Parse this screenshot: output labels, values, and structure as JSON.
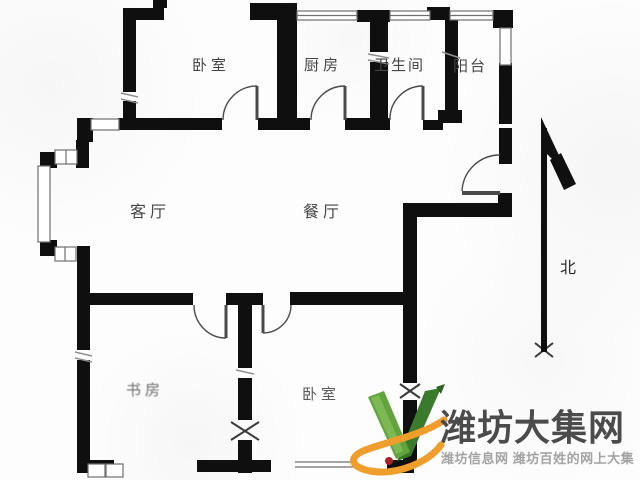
{
  "floorplan": {
    "type": "apartment-floor-plan",
    "rooms": [
      {
        "id": "bedroom-top",
        "label": "卧室"
      },
      {
        "id": "kitchen",
        "label": "厨房"
      },
      {
        "id": "bathroom",
        "label": "卫生间"
      },
      {
        "id": "balcony",
        "label": "阳台"
      },
      {
        "id": "living-room",
        "label": "客厅"
      },
      {
        "id": "dining-room",
        "label": "餐厅"
      },
      {
        "id": "study",
        "label": "书房"
      },
      {
        "id": "bedroom-bottom",
        "label": "卧室"
      }
    ],
    "compass": {
      "label": "北"
    }
  },
  "watermark": {
    "site_name": "潍坊大集网",
    "tagline": "潍坊信息网 潍坊百姓的网上大集"
  },
  "colors": {
    "wall": "#0f0f0f",
    "door_line": "#4a4a4a",
    "window_line": "#6f6f6f",
    "label_text": "#454545",
    "logo_green_dark": "#3a7a2c",
    "logo_green_light": "#62a33e",
    "logo_orange": "#f09e2b",
    "logo_red": "#a82222",
    "logo_text": "#4b4b4b",
    "logo_subtext": "#a3a3a3"
  }
}
